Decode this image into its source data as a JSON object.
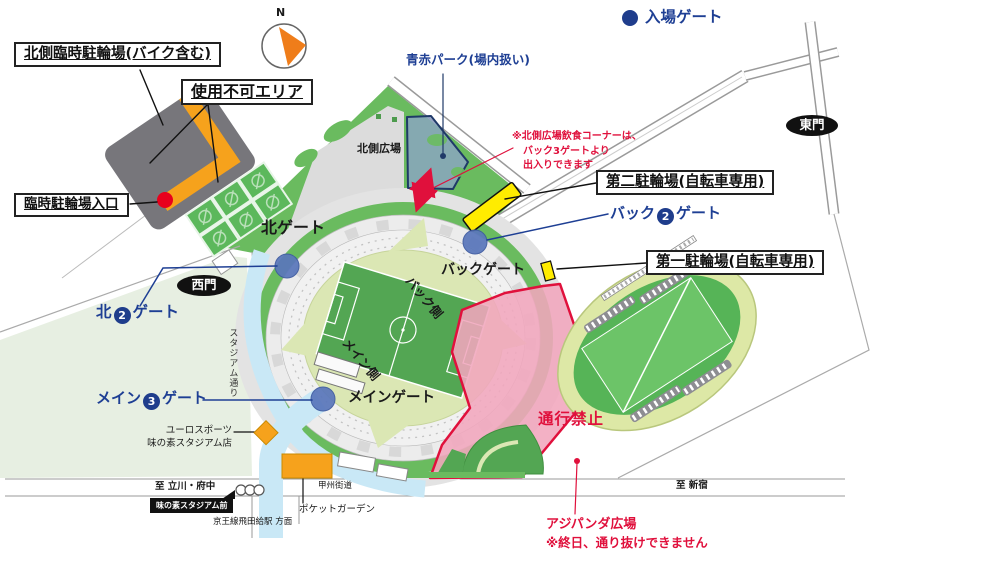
{
  "legend": {
    "entry_gate_label": "入場ゲート"
  },
  "compass": {
    "north_label": "N"
  },
  "boxes": {
    "north_temp_parking": "北側臨時駐輪場(バイク含む)",
    "unusable_area": "使用不可エリア",
    "temp_parking_entrance": "臨時駐輪場入口",
    "bicycle_parking_no2": "第二駐輪場(自転車専用)",
    "bicycle_parking_no1": "第一駐輪場(自転車専用)"
  },
  "gates": {
    "north_gate": "北ゲート",
    "back_gate": "バックゲート",
    "main_gate": "メインゲート",
    "north2": {
      "pre": "北",
      "num": "2",
      "post": "ゲート"
    },
    "back2": {
      "pre": "バック",
      "num": "2",
      "post": "ゲート"
    },
    "main3": {
      "pre": "メイン",
      "num": "3",
      "post": "ゲート"
    },
    "west_gate": "西門",
    "east_gate": "東門"
  },
  "areas": {
    "north_plaza": "北側広場",
    "aoaka_park": "青赤パーク(場内扱い)",
    "back_side": "バック側",
    "main_side": "メイン側",
    "no_passage": "通行禁止",
    "ajipanda_plaza": "アジパンダ広場",
    "ajipanda_note": "※終日、通り抜けできません"
  },
  "notes": {
    "food_corner_line1": "※北側広場飲食コーナーは、",
    "food_corner_line2": "バック3ゲートより",
    "food_corner_line3": "出入りできます"
  },
  "streets": {
    "stadium_street": "スタジアム通り",
    "koshu_kaido": "甲州街道",
    "to_tachikawa_fuchu": "至 立川・府中",
    "to_shinjuku": "至 新宿",
    "bus_stop": "味の素スタジアム前",
    "station_direction": "京王線飛田給駅 方面"
  },
  "shops": {
    "euro_sports_line1": "ユーロスポーツ",
    "euro_sports_line2": "味の素スタジアム店",
    "pocket_garden": "ポケットガーデン"
  },
  "colors": {
    "gate_blue": "#1e3f94",
    "gate_circle_fill": "#5a77bb",
    "pink_area": "#f1a6bd",
    "alert_red": "#e0103c",
    "parking_yellow": "#ffec00",
    "field_green": "#53a653",
    "ring_green": "#6abb5f",
    "walkway_cyan": "#c9e8f6",
    "unusable_gray": "#77767b",
    "strip_orange": "#f6a21c"
  }
}
